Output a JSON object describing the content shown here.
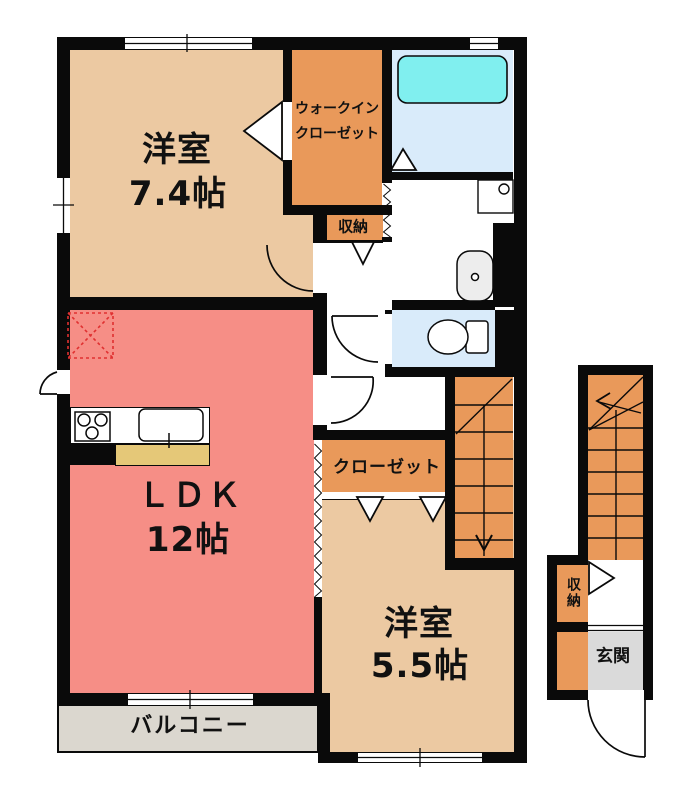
{
  "title": "apartment-floor-plan",
  "colors": {
    "room_beige": "#ECC9A2",
    "closet_orange": "#E9995A",
    "ldk_pink": "#F68E86",
    "bath_blue": "#D9EBFA",
    "tub_cyan": "#80EFEF",
    "balcony_gray": "#DBD7CF",
    "entrance_gray": "#DADADA",
    "counter_yellow": "#E5C878",
    "hall_white": "#FFFFFF",
    "wall_black": "#0A0A0A",
    "refrigerator_red": "#E03030"
  },
  "rooms": {
    "bedroom_main": {
      "name": "洋室",
      "size": "7.4帖"
    },
    "walk_in_closet": {
      "line1": "ウォークイン",
      "line2": "クローゼット"
    },
    "storage_main": {
      "label": "収納"
    },
    "ldk": {
      "name": "ＬＤＫ",
      "size": "12帖"
    },
    "closet": {
      "label": "クローゼット"
    },
    "bedroom_second": {
      "name": "洋室",
      "size": "5.5帖"
    },
    "balcony": {
      "label": "バルコニー"
    },
    "storage_entry": {
      "label": "収納"
    },
    "entrance": {
      "label": "玄関"
    }
  },
  "fixtures": [
    "bathtub",
    "vanity-sink",
    "wash-basin",
    "toilet",
    "gas-stove",
    "kitchen-sink",
    "refrigerator-space",
    "staircase-down",
    "staircase-up",
    "accordion-door",
    "entry-door"
  ]
}
